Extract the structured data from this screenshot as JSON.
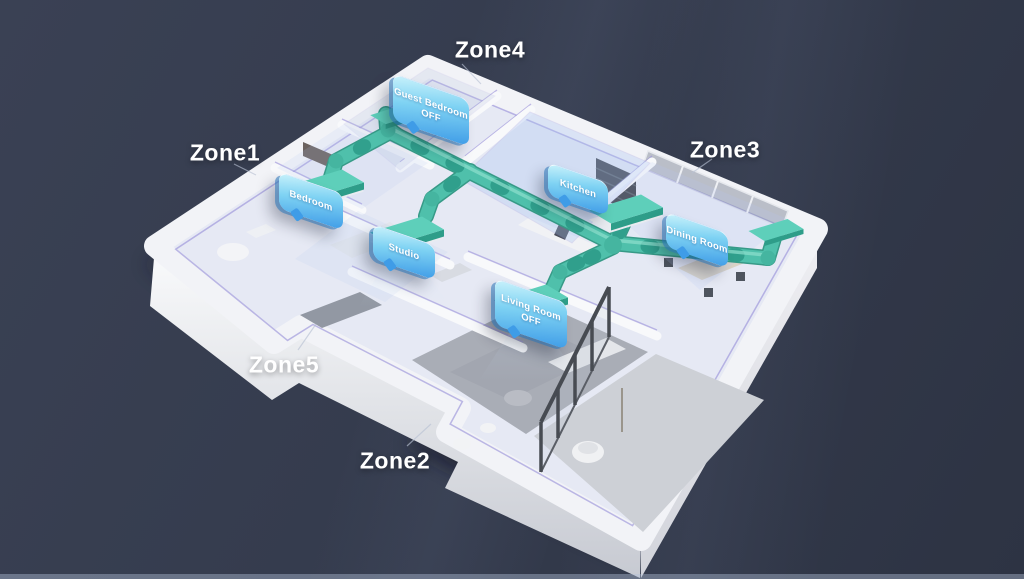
{
  "scene": {
    "type": "3d-isometric-floorplan",
    "description": "Smart home HVAC zoning visualization: five labeled air-conditioning zones with per-room ceiling duct vents and status tags",
    "background_color": "#343b4d",
    "colors": {
      "duct_teal": "#4fc0ab",
      "duct_dark": "#2d9c89",
      "tag_gradient_top": "#c9f2fb",
      "tag_gradient_bottom": "#3f9ce7",
      "wall_white": "#f2f3f7",
      "floor_lavender": "#e6e9f4",
      "carpet_gray": "#a9adb6",
      "accent_purple": "#8d83d5",
      "zone_label_color": "#ffffff"
    }
  },
  "zone_labels": [
    {
      "id": "zone1",
      "text": "Zone1"
    },
    {
      "id": "zone2",
      "text": "Zone2"
    },
    {
      "id": "zone3",
      "text": "Zone3"
    },
    {
      "id": "zone4",
      "text": "Zone4"
    },
    {
      "id": "zone5",
      "text": "Zone5"
    }
  ],
  "room_tags": [
    {
      "id": "guest-bedroom",
      "room": "Guest Bedroom",
      "status": "OFF"
    },
    {
      "id": "bedroom",
      "room": "Bedroom",
      "status": ""
    },
    {
      "id": "studio",
      "room": "Studio",
      "status": ""
    },
    {
      "id": "kitchen",
      "room": "Kitchen",
      "status": ""
    },
    {
      "id": "dining-room",
      "room": "Dining Room",
      "status": ""
    },
    {
      "id": "living-room",
      "room": "Living Room",
      "status": "OFF"
    }
  ]
}
